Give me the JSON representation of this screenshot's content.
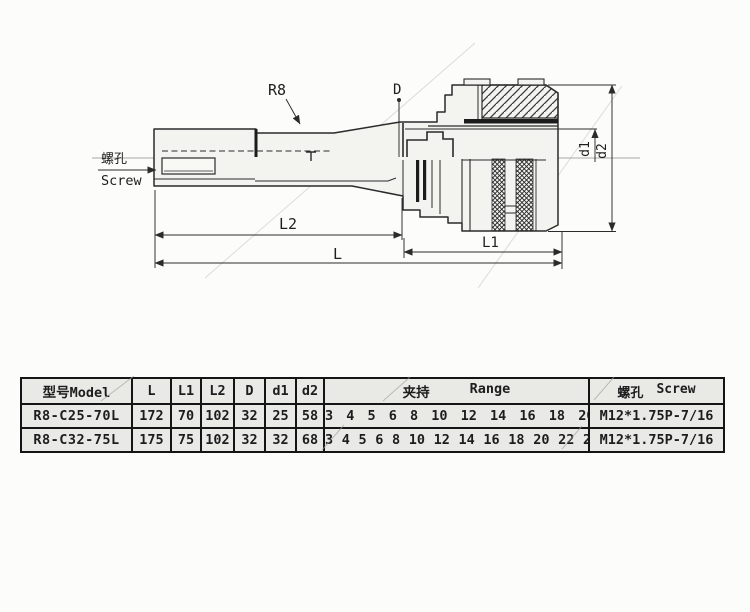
{
  "drawing": {
    "callouts": {
      "r8": "R8",
      "d": "D",
      "d1": "d1",
      "d2": "d2",
      "l": "L",
      "l1": "L1",
      "l2": "L2",
      "screw_cn": "螺孔",
      "screw_en": "Screw"
    },
    "colors": {
      "outline": "#2b2b2b",
      "centerline": "#a8a8a6",
      "fill": "#f3f3f0",
      "watermark": "#c6c6c4"
    }
  },
  "table": {
    "header": {
      "model": "型号Model",
      "l": "L",
      "l1": "L1",
      "l2": "L2",
      "d": "D",
      "d1": "d1",
      "d2": "d2",
      "range_cn": "夹持",
      "range_en": "Range",
      "screw_cn": "螺孔",
      "screw_en": "Screw"
    },
    "rows": [
      {
        "model": "R8-C25-70L",
        "l": "172",
        "l1": "70",
        "l2": "102",
        "d": "32",
        "d1": "25",
        "d2": "58",
        "range": "3 4 5 6 8 10 12 14 16 18 20",
        "screw": "M12*1.75P-7/16"
      },
      {
        "model": "R8-C32-75L",
        "l": "175",
        "l1": "75",
        "l2": "102",
        "d": "32",
        "d1": "32",
        "d2": "68",
        "range": "3 4 5 6 8 10 12 14 16 18 20 22 24 25",
        "screw": "M12*1.75P-7/16"
      }
    ]
  }
}
